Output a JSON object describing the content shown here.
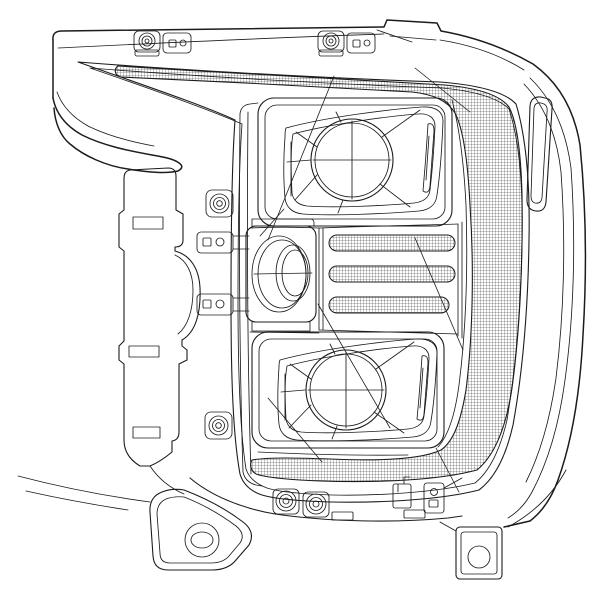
{
  "figure": {
    "type": "technical-line-drawing",
    "subject": "Truck headlight assembly, front elevation, wireframe patent-style drawing",
    "colors": {
      "background": "#ffffff",
      "line": "#1c1c1c"
    },
    "parts": {
      "housing": "outer-housing-shell",
      "top_clips": "two pairs of top mounting clips (round grommet clip + flat clip with two holes)",
      "drl_light_bar": "C-shaped cross-hatched daytime-running-light bar (top strip, right column, bottom strip)",
      "upper_projector": "upper projector lens with crosshair reticle in faceted reflector bowl",
      "lower_projector": "lower projector lens with crosshair reticle in faceted reflector bowl",
      "led_slats": "three horizontal cross-hatched LED slats",
      "turn_signal": "cylindrical side lamp in rectangular pocket",
      "left_bracket": "stepped left mounting bracket with three slots",
      "screw_bosses": "screw bosses with concentric rings",
      "tab_clips": "side tab clips with square and round holes",
      "left_foot": "triangular lower-left mounting foot with bolt hole",
      "right_foot": "rectangular lower-right mounting foot with bolt hole",
      "side_tab": "elongated tab on right housing flank",
      "shading": "diagonal glare lines"
    }
  }
}
